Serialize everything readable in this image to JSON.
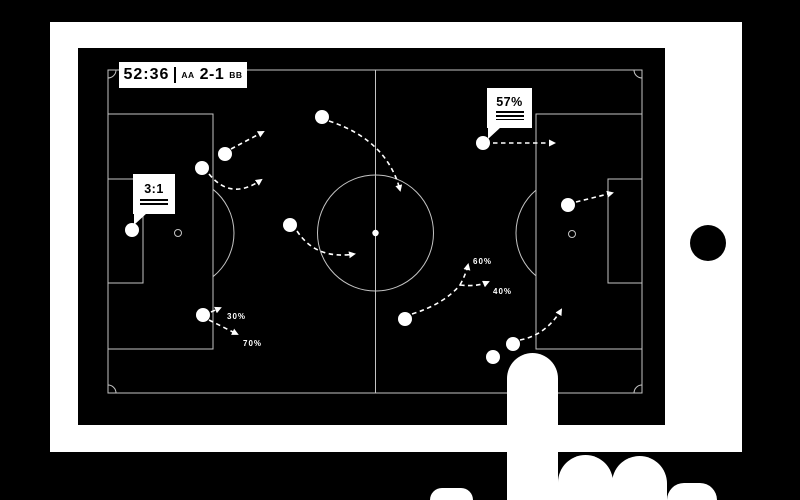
{
  "scoreboard": {
    "time": "52:36",
    "separator": "|",
    "home_team": "AA",
    "score": "2-1",
    "away_team": "BB"
  },
  "tooltips": {
    "possession": {
      "value": "57%"
    },
    "ratio": {
      "value": "3:1"
    }
  },
  "colors": {
    "background": "#000000",
    "bezel": "#ffffff",
    "screen": "#000000",
    "pitch_line": "#c4c4c4",
    "accent": "#ffffff",
    "text_dark": "#000000"
  },
  "tactics": {
    "players": [
      [
        147,
        106
      ],
      [
        124,
        120
      ],
      [
        244,
        69
      ],
      [
        212,
        177
      ],
      [
        54,
        182
      ],
      [
        125,
        267
      ],
      [
        327,
        271
      ],
      [
        405,
        95
      ],
      [
        490,
        157
      ],
      [
        435,
        296
      ],
      [
        415,
        309
      ]
    ],
    "center_dot": [
      297.5,
      185
    ],
    "penalty_spots": [
      [
        100,
        185
      ],
      [
        494,
        186
      ]
    ],
    "movement_arrows": [
      {
        "d": "M153,101 L185,84",
        "head": true
      },
      {
        "d": "M131,126 Q153,153 183,132",
        "head": true
      },
      {
        "d": "M251,73 Q309,92 322,142",
        "head": true
      },
      {
        "d": "M219,183 Q238,212 276,206",
        "head": true
      },
      {
        "d": "M133,264 L142,260",
        "head": true
      },
      {
        "d": "M131,272 L159,286",
        "head": true
      },
      {
        "d": "M334,266 Q366,256 382,237",
        "head": false
      },
      {
        "d": "M382,237 Q388,226 390,217",
        "head": true
      },
      {
        "d": "M382,237 Q399,239 410,234",
        "head": true
      },
      {
        "d": "M415,95 L476,95",
        "head": true
      },
      {
        "d": "M498,154 L534,145",
        "head": true
      },
      {
        "d": "M442,292 Q468,287 483,262",
        "head": true
      }
    ],
    "pass_labels": [
      {
        "text": "30%",
        "x": 149,
        "y": 271
      },
      {
        "text": "70%",
        "x": 165,
        "y": 298
      },
      {
        "text": "60%",
        "x": 395,
        "y": 216
      },
      {
        "text": "40%",
        "x": 415,
        "y": 246
      }
    ]
  }
}
